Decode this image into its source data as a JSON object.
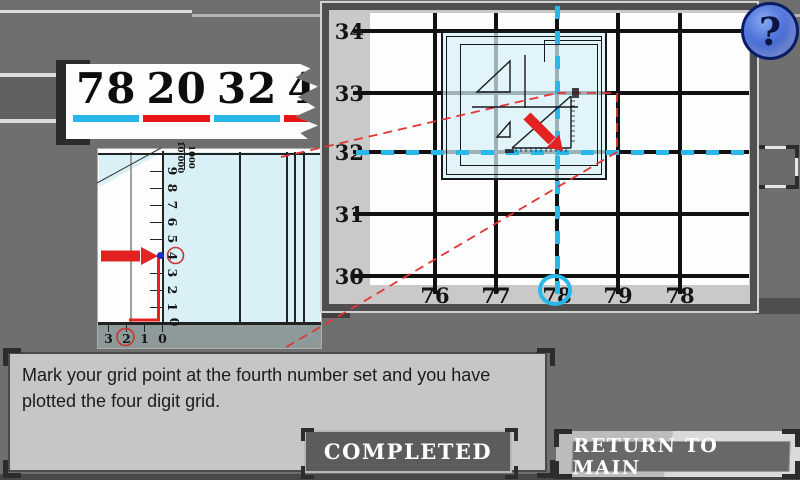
{
  "banner": {
    "number": "78203240",
    "pairs": [
      {
        "digits": "78",
        "underline": "#29b5e8"
      },
      {
        "digits": "20",
        "underline": "#e81515"
      },
      {
        "digits": "32",
        "underline": "#29b5e8"
      },
      {
        "digits": "40",
        "underline": "#e81515"
      }
    ]
  },
  "map": {
    "row_labels": [
      "34",
      "33",
      "32",
      "31",
      "30"
    ],
    "col_labels": [
      "76",
      "77",
      "78",
      "79",
      "78"
    ],
    "circled_col_label": "78",
    "circled_row_label": "32",
    "grid_color": "#111111",
    "highlight_cyan": "#2ab7ea",
    "highlight_red": "#e32222"
  },
  "scale": {
    "tick_labels": [
      "0",
      "1",
      "2",
      "3",
      "4",
      "5",
      "6",
      "7",
      "8",
      "9"
    ],
    "fraction_top": "1000",
    "fraction_bottom": "10,000",
    "bottom_labels": [
      "3",
      "2",
      "1",
      "0"
    ],
    "circled_tick": "4",
    "circled_bottom": "2"
  },
  "instruction": {
    "text": "Mark your grid point at the fourth number set and you have plotted the four digit grid."
  },
  "buttons": {
    "completed": "COMPLETED",
    "return_to_main": "RETURN TO MAIN",
    "help": "?"
  }
}
